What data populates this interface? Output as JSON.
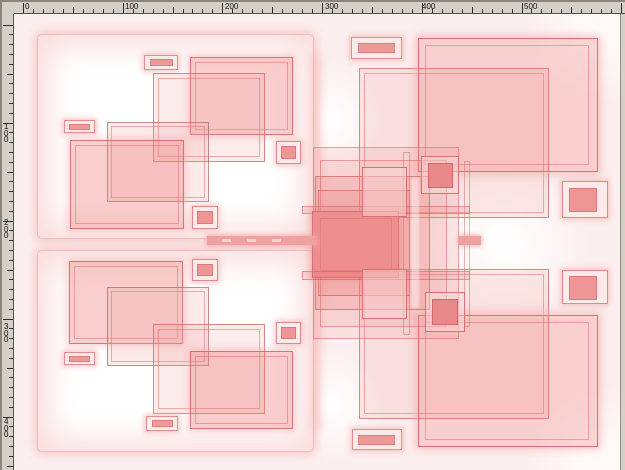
{
  "rulers": {
    "horizontal": {
      "labels": [
        {
          "text": "0",
          "x": 23
        },
        {
          "text": "100",
          "x": 123
        },
        {
          "text": "200",
          "x": 223
        },
        {
          "text": "300",
          "x": 323
        },
        {
          "text": "400",
          "x": 420
        },
        {
          "text": "500",
          "x": 522
        }
      ],
      "tick_origin": 23,
      "tick_step": 9.97,
      "tick_count": 61
    },
    "vertical": {
      "labels": [
        {
          "text": "100",
          "y": 122
        },
        {
          "text": "200",
          "y": 218
        },
        {
          "text": "300",
          "y": 322
        },
        {
          "text": "400",
          "y": 417
        }
      ],
      "tick_origin": 24.5,
      "tick_step": 9.8,
      "tick_count": 46
    }
  },
  "colors": {
    "ruler_bg": "#d4d0c8",
    "tick": "#2b2b2b",
    "canvas_tint": "#fcefef",
    "accent_red": "#e06a6a",
    "fill_red": "#ef8e8e"
  },
  "shapes": [
    {
      "n": "panel-top-left",
      "c": "panel",
      "x": 37,
      "y": 34,
      "w": 277,
      "h": 205
    },
    {
      "n": "panel-bottom-left",
      "c": "panel",
      "x": 37,
      "y": 250,
      "w": 277,
      "h": 202
    },
    {
      "n": "p1-pill-top-outer",
      "c": "pillO",
      "x": 144,
      "y": 55,
      "w": 34,
      "h": 15
    },
    {
      "n": "p1-pill-top-inner",
      "c": "pillI",
      "x": 150,
      "y": 59,
      "w": 23,
      "h": 7
    },
    {
      "n": "p1-rect-top-right",
      "c": "fillMed",
      "x": 190,
      "y": 57,
      "w": 103,
      "h": 78
    },
    {
      "n": "p1-rect-top-right-ring",
      "c": "ring",
      "x": 195,
      "y": 62,
      "w": 93,
      "h": 68
    },
    {
      "n": "p1-square-outline",
      "c": "fillLight",
      "x": 153,
      "y": 73,
      "w": 112,
      "h": 89
    },
    {
      "n": "p1-square-outline-ring",
      "c": "ring",
      "x": 158,
      "y": 78,
      "w": 102,
      "h": 79
    },
    {
      "n": "p1-pill-left-outer",
      "c": "pillO",
      "x": 64,
      "y": 120,
      "w": 31,
      "h": 13
    },
    {
      "n": "p1-pill-left-inner",
      "c": "pillI",
      "x": 69,
      "y": 124,
      "w": 21,
      "h": 6
    },
    {
      "n": "p1-rect-center",
      "c": "outlineGray",
      "x": 107,
      "y": 122,
      "w": 102,
      "h": 80
    },
    {
      "n": "p1-rect-center-ring",
      "c": "ring",
      "x": 111,
      "y": 126,
      "w": 94,
      "h": 72
    },
    {
      "n": "p1-rect-bottom-left",
      "c": "fillMed",
      "x": 70,
      "y": 140,
      "w": 114,
      "h": 89
    },
    {
      "n": "p1-rect-bottom-left-ring",
      "c": "ring",
      "x": 75,
      "y": 145,
      "w": 104,
      "h": 79
    },
    {
      "n": "p1-square-right-outer",
      "c": "sqO",
      "x": 276,
      "y": 141,
      "w": 25,
      "h": 23
    },
    {
      "n": "p1-square-right-inner",
      "c": "sqI",
      "x": 281,
      "y": 146,
      "w": 15,
      "h": 13
    },
    {
      "n": "p1-square-bottom-outer",
      "c": "sqO",
      "x": 192,
      "y": 206,
      "w": 26,
      "h": 23
    },
    {
      "n": "p1-square-bottom-inner",
      "c": "sqI",
      "x": 197,
      "y": 211,
      "w": 16,
      "h": 13
    },
    {
      "n": "p2-rect-top-left",
      "c": "fillMed",
      "x": 69,
      "y": 261,
      "w": 114,
      "h": 83
    },
    {
      "n": "p2-rect-top-left-ring",
      "c": "ring",
      "x": 74,
      "y": 266,
      "w": 104,
      "h": 73
    },
    {
      "n": "p2-square-top-outer",
      "c": "sqO",
      "x": 192,
      "y": 259,
      "w": 26,
      "h": 22
    },
    {
      "n": "p2-square-top-inner",
      "c": "sqI",
      "x": 197,
      "y": 264,
      "w": 16,
      "h": 12
    },
    {
      "n": "p2-rect-center",
      "c": "outlineGray",
      "x": 107,
      "y": 287,
      "w": 102,
      "h": 79
    },
    {
      "n": "p2-rect-center-ring",
      "c": "ring",
      "x": 111,
      "y": 291,
      "w": 94,
      "h": 71
    },
    {
      "n": "p2-square-outline",
      "c": "fillLight",
      "x": 153,
      "y": 324,
      "w": 112,
      "h": 90
    },
    {
      "n": "p2-square-outline-ring",
      "c": "ring",
      "x": 158,
      "y": 329,
      "w": 102,
      "h": 80
    },
    {
      "n": "p2-pill-left-outer",
      "c": "pillO",
      "x": 64,
      "y": 352,
      "w": 31,
      "h": 13
    },
    {
      "n": "p2-pill-left-inner",
      "c": "pillI",
      "x": 69,
      "y": 356,
      "w": 21,
      "h": 6
    },
    {
      "n": "p2-rect-bottom-right",
      "c": "fillMed",
      "x": 190,
      "y": 351,
      "w": 103,
      "h": 78
    },
    {
      "n": "p2-rect-bottom-right-ring",
      "c": "ring",
      "x": 195,
      "y": 356,
      "w": 93,
      "h": 68
    },
    {
      "n": "p2-square-right-outer",
      "c": "sqO",
      "x": 276,
      "y": 322,
      "w": 25,
      "h": 22
    },
    {
      "n": "p2-square-right-inner",
      "c": "sqI",
      "x": 281,
      "y": 327,
      "w": 15,
      "h": 12
    },
    {
      "n": "p2-pill-bottom-outer",
      "c": "pillO",
      "x": 146,
      "y": 416,
      "w": 32,
      "h": 15
    },
    {
      "n": "p2-pill-bottom-inner",
      "c": "pillI",
      "x": 152,
      "y": 420,
      "w": 21,
      "h": 7
    },
    {
      "n": "glow-strip-left-of-cluster",
      "c": "soft",
      "x": 310,
      "y": 55,
      "w": 12,
      "h": 375
    },
    {
      "n": "r-square-outline-top",
      "c": "fillLight",
      "x": 359,
      "y": 68,
      "w": 190,
      "h": 150
    },
    {
      "n": "r-square-outline-top-ring",
      "c": "ring",
      "x": 364,
      "y": 73,
      "w": 180,
      "h": 140
    },
    {
      "n": "r-big-square-top-right",
      "c": "fillBig",
      "x": 418,
      "y": 38,
      "w": 180,
      "h": 134
    },
    {
      "n": "r-big-square-top-right-ring",
      "c": "ring",
      "x": 425,
      "y": 45,
      "w": 164,
      "h": 120
    },
    {
      "n": "r-square-outline-bottom",
      "c": "fillLight",
      "x": 359,
      "y": 269,
      "w": 190,
      "h": 150
    },
    {
      "n": "r-square-outline-bottom-ring",
      "c": "ring",
      "x": 364,
      "y": 274,
      "w": 180,
      "h": 140
    },
    {
      "n": "r-big-square-bottom-right",
      "c": "fillBig",
      "x": 418,
      "y": 315,
      "w": 180,
      "h": 132
    },
    {
      "n": "r-big-square-bottom-right-ring",
      "c": "ring",
      "x": 425,
      "y": 322,
      "w": 164,
      "h": 118
    },
    {
      "n": "cluster-outer",
      "c": "fillLighter",
      "x": 313,
      "y": 147,
      "w": 146,
      "h": 192
    },
    {
      "n": "cluster-outer2",
      "c": "fillLighter",
      "x": 320,
      "y": 160,
      "w": 127,
      "h": 167
    },
    {
      "n": "cluster-mid",
      "c": "fillLight2",
      "x": 315,
      "y": 176,
      "w": 115,
      "h": 134
    },
    {
      "n": "cluster-mid2",
      "c": "fillLight2",
      "x": 318,
      "y": 190,
      "w": 92,
      "h": 106
    },
    {
      "n": "cluster-hband-top",
      "c": "hband",
      "x": 302,
      "y": 206,
      "w": 168,
      "h": 8
    },
    {
      "n": "cluster-core",
      "c": "fillDark",
      "x": 312,
      "y": 211,
      "w": 87,
      "h": 67
    },
    {
      "n": "cluster-core-ring",
      "c": "ring",
      "x": 320,
      "y": 218,
      "w": 72,
      "h": 53
    },
    {
      "n": "cluster-hband-bottom",
      "c": "hband",
      "x": 302,
      "y": 271,
      "w": 168,
      "h": 9
    },
    {
      "n": "cluster-vline",
      "c": "ring",
      "x": 403,
      "y": 152,
      "w": 7,
      "h": 183
    },
    {
      "n": "cluster-vline2",
      "c": "ring",
      "x": 464,
      "y": 161,
      "w": 6,
      "h": 166
    },
    {
      "n": "cluster-square-top-left",
      "c": "clusterSq",
      "x": 362,
      "y": 167,
      "w": 45,
      "h": 50
    },
    {
      "n": "cluster-square-bottom-left",
      "c": "clusterSq",
      "x": 362,
      "y": 269,
      "w": 45,
      "h": 50
    },
    {
      "n": "cluster-light-column",
      "c": "lightcol",
      "x": 411,
      "y": 178,
      "w": 8,
      "h": 130
    },
    {
      "n": "connector-band",
      "c": "band",
      "x": 207,
      "y": 236,
      "w": 110,
      "h": 9
    },
    {
      "n": "connector-dash-1",
      "c": "dash",
      "x": 222,
      "y": 239,
      "w": 9,
      "h": 3
    },
    {
      "n": "connector-dash-2",
      "c": "dash",
      "x": 247,
      "y": 239,
      "w": 9,
      "h": 3
    },
    {
      "n": "connector-dash-3",
      "c": "dash",
      "x": 272,
      "y": 239,
      "w": 9,
      "h": 3
    },
    {
      "n": "connector-band-right",
      "c": "band",
      "x": 459,
      "y": 236,
      "w": 22,
      "h": 9
    },
    {
      "n": "r-small-square-top-outer",
      "c": "clusterSq",
      "x": 421,
      "y": 156,
      "w": 38,
      "h": 38
    },
    {
      "n": "r-small-square-top-inner",
      "c": "sqIdark",
      "x": 428,
      "y": 163,
      "w": 25,
      "h": 25
    },
    {
      "n": "r-small-square-bottom-outer",
      "c": "clusterSq",
      "x": 425,
      "y": 292,
      "w": 40,
      "h": 40
    },
    {
      "n": "r-small-square-bottom-inner",
      "c": "sqIdark",
      "x": 432,
      "y": 299,
      "w": 26,
      "h": 26
    },
    {
      "n": "r-far-square-top-outer",
      "c": "sqO",
      "x": 562,
      "y": 181,
      "w": 46,
      "h": 37
    },
    {
      "n": "r-far-square-top-inner",
      "c": "sqI",
      "x": 569,
      "y": 188,
      "w": 28,
      "h": 24
    },
    {
      "n": "r-far-square-bottom-outer",
      "c": "sqO",
      "x": 562,
      "y": 270,
      "w": 46,
      "h": 34
    },
    {
      "n": "r-far-square-bottom-inner",
      "c": "sqI",
      "x": 569,
      "y": 276,
      "w": 28,
      "h": 24
    },
    {
      "n": "r-pill-top-outer",
      "c": "pillO",
      "x": 351,
      "y": 37,
      "w": 51,
      "h": 22
    },
    {
      "n": "r-pill-top-inner",
      "c": "pillI",
      "x": 358,
      "y": 43,
      "w": 37,
      "h": 10
    },
    {
      "n": "r-pill-bottom-outer",
      "c": "pillO",
      "x": 352,
      "y": 429,
      "w": 50,
      "h": 21
    },
    {
      "n": "r-pill-bottom-inner",
      "c": "pillI",
      "x": 358,
      "y": 435,
      "w": 37,
      "h": 10
    }
  ]
}
